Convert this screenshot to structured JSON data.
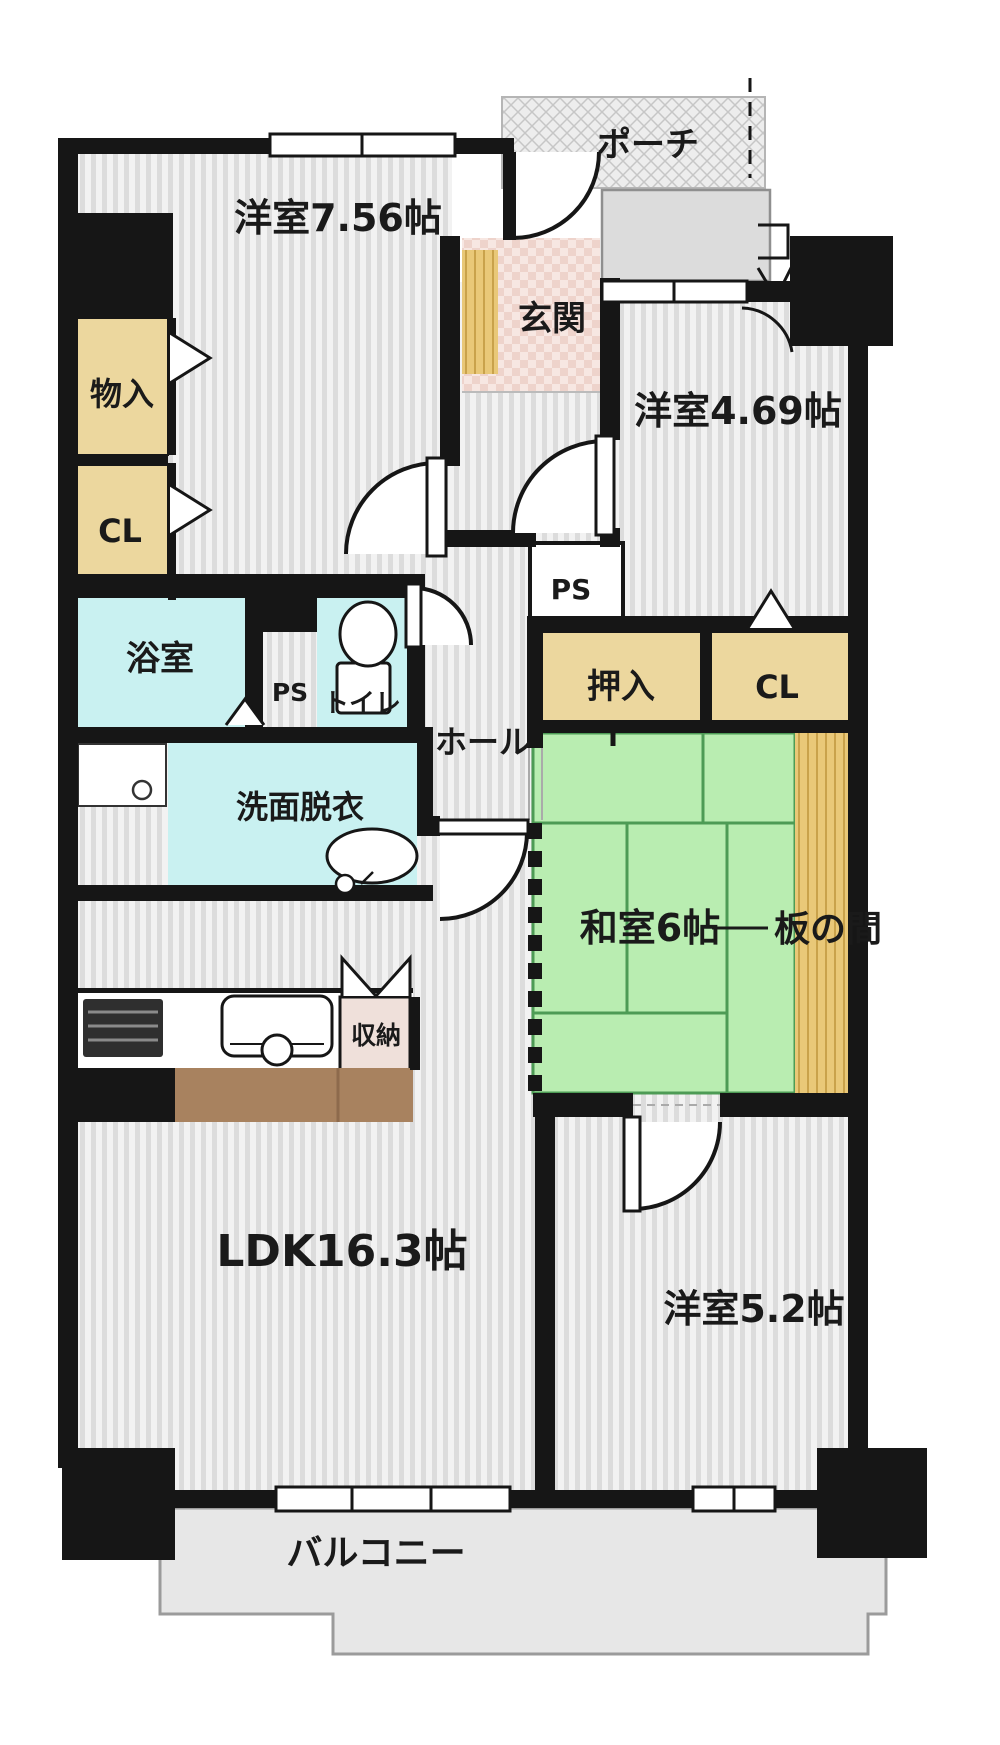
{
  "document": {
    "type": "japanese-apartment-floor-plan",
    "layout": "3LDK"
  },
  "labels": {
    "room_west1": "洋室7.56帖",
    "room_west2": "洋室4.69帖",
    "room_tatami": "和室6帖",
    "wood_floor": "板の間",
    "room_west3": "洋室5.2帖",
    "ldk": "LDK16.3帖",
    "entrance": "玄関",
    "porch": "ポーチ",
    "hall": "ホール",
    "bath": "浴室",
    "toilet": "トイレ",
    "washroom": "洗面脱衣",
    "balcony": "バルコニー",
    "storage_left": "物入",
    "closet_left": "CL",
    "oshiire": "押入",
    "closet_right": "CL",
    "kitchen_storage": "収納",
    "ps_wet": "PS",
    "ps_hall": "PS"
  },
  "colors": {
    "wall": "#161616",
    "floor_base": "#f2f2f2",
    "floor_stripe": "#dcdcdc",
    "closet": "#ecd79e",
    "wet_area": "#c9f1f1",
    "tatami": "#b9edb1",
    "tatami_line": "#4d9b55",
    "wood": "#e9c878",
    "wood_line": "#c9a24b",
    "entrance_floor": "#f7e7e2",
    "entrance_check": "#eed3cb",
    "counter": "#a8825f",
    "counter_line": "#8d6a4c",
    "balcony": "#e7e7e7",
    "porch_bg": "#ededed",
    "porch_line": "#c6c6c6",
    "gray_box": "#dcdcdc",
    "outline": "#9b9b9b",
    "text": "#1a1a1a"
  }
}
